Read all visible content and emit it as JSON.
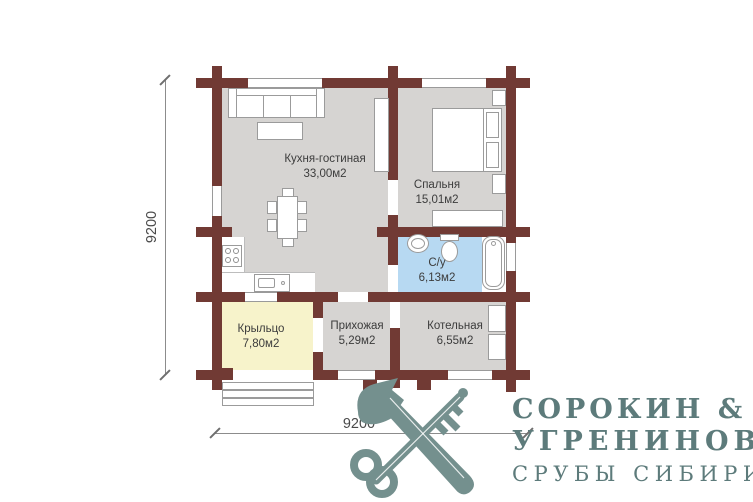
{
  "plan": {
    "rooms": {
      "kitchen_living": {
        "name": "Кухня-гостиная",
        "area": "33,00м2"
      },
      "bedroom": {
        "name": "Спальня",
        "area": "15,01м2"
      },
      "bathroom": {
        "name": "С/у",
        "area": "6,13м2"
      },
      "porch": {
        "name": "Крыльцо",
        "area": "7,80м2"
      },
      "hallway": {
        "name": "Прихожая",
        "area": "5,29м2"
      },
      "boiler": {
        "name": "Котельная",
        "area": "6,55м2"
      }
    },
    "dimensions": {
      "left": "9200",
      "bottom": "9200"
    },
    "colors": {
      "wall": "#713a34",
      "floor": "#d6d4d2",
      "bathroom": "#b7d9f2",
      "porch": "#f7f3cb",
      "furniture_border": "#9b9b9b",
      "label": "#3c3c3c",
      "logo_text": "#5d7b7b",
      "logo_emblem": "#74908e"
    }
  },
  "icons": {
    "logo_emblem": "crossed-axe-and-key"
  },
  "logo": {
    "line1": "СОРОКИН &",
    "line2": "УГРЕНИНОВ",
    "line3": "СРУБЫ СИБИРИ"
  }
}
